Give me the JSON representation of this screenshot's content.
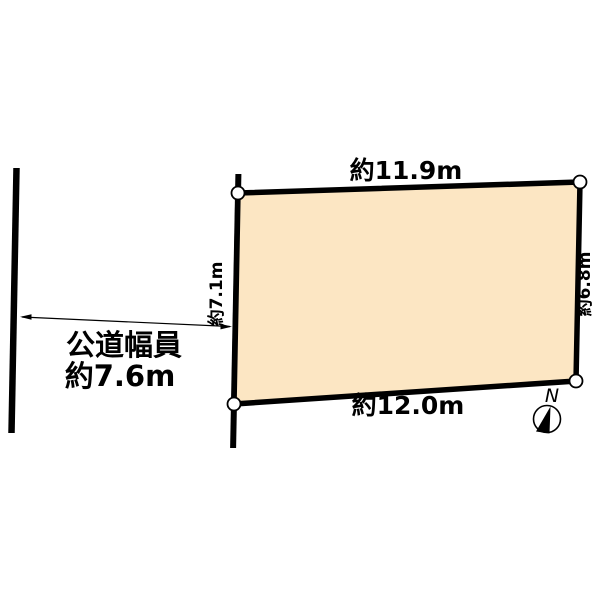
{
  "page": {
    "background": "#ffffff"
  },
  "diagram": {
    "type": "land-plot-survey",
    "parcel": {
      "fill": "#FCE6C3",
      "stroke": "#000000",
      "top_dimension": "約11.9m",
      "right_dimension": "約6.8m",
      "bottom_dimension": "約12.0m",
      "left_dimension": "約7.1m"
    },
    "road": {
      "width_label_line1": "公道幅員",
      "width_label_line2": "約7.6m"
    },
    "compass": {
      "north_label": "N"
    }
  }
}
